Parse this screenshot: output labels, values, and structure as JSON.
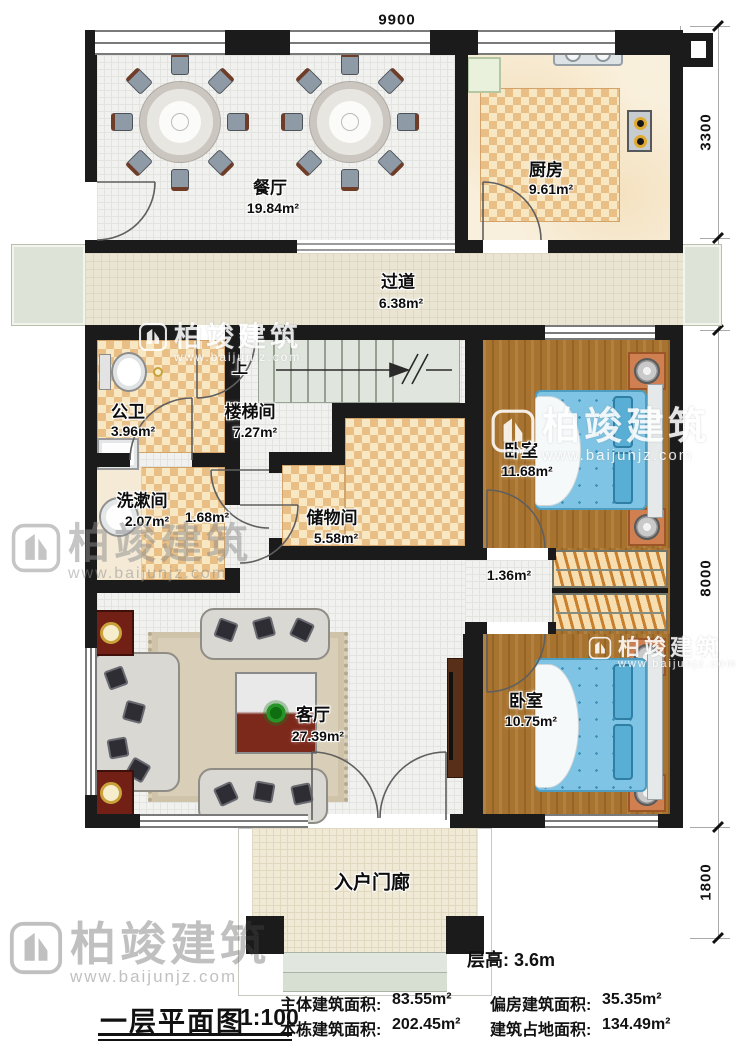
{
  "plan": {
    "title": "一层平面图",
    "scale": "1:100",
    "floor_height": "层高: 3.6m",
    "stats": {
      "main": {
        "label": "主体建筑面积:",
        "value": "83.55m²"
      },
      "annex": {
        "label": "偏房建筑面积:",
        "value": "35.35m²"
      },
      "building": {
        "label": "本栋建筑面积:",
        "value": "202.45m²"
      },
      "footprint": {
        "label": "建筑占地面积:",
        "value": "134.49m²"
      }
    }
  },
  "rooms": {
    "dining": {
      "name": "餐厅",
      "area": "19.84m²"
    },
    "kitchen": {
      "name": "厨房",
      "area": "9.61m²"
    },
    "corridor": {
      "name": "过道",
      "area": "6.38m²"
    },
    "bathroom": {
      "name": "公卫",
      "area": "3.96m²"
    },
    "stairwell": {
      "name": "楼梯间",
      "area": "7.27m²"
    },
    "washroom": {
      "name": "洗漱间",
      "area": "2.07m²"
    },
    "storage": {
      "name": "储物间",
      "area": "5.58m²"
    },
    "bedroom1": {
      "name": "卧室",
      "area": "11.68m²"
    },
    "bedroom2": {
      "name": "卧室",
      "area": "10.75m²"
    },
    "living": {
      "name": "客厅",
      "area": "27.39m²"
    },
    "porch": {
      "name": "入户门廊"
    },
    "hall_upper": {
      "area": "1.68m²"
    },
    "hall_bedrooms": {
      "area": "1.36m²"
    }
  },
  "dimensions": {
    "top": "9900",
    "right": [
      "3300",
      "1500",
      "8000",
      "1800"
    ]
  },
  "stairs": {
    "up_label": "上"
  },
  "watermark": {
    "brand": "柏竣建筑",
    "url": "www.baijunjz.com"
  }
}
